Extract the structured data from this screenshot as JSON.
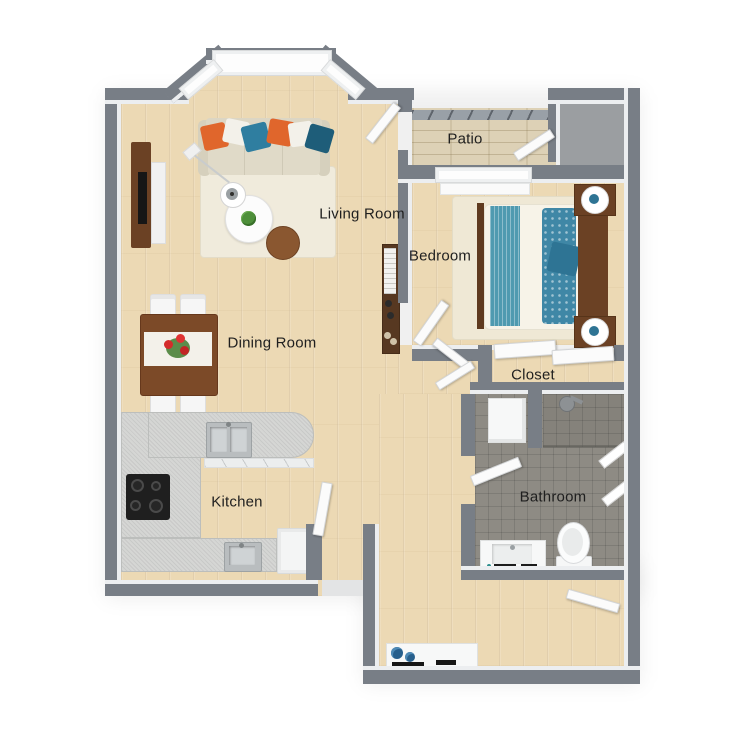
{
  "title": "One-bedroom apartment 3D floor plan",
  "rooms": {
    "patio": {
      "label": "Patio"
    },
    "living_room": {
      "label": "Living Room"
    },
    "bedroom": {
      "label": "Bedroom"
    },
    "dining_room": {
      "label": "Dining Room"
    },
    "closet": {
      "label": "Closet"
    },
    "kitchen": {
      "label": "Kitchen"
    },
    "bathroom": {
      "label": "Bathroom"
    }
  },
  "furniture": {
    "living_room": [
      "sofa",
      "throw-pillows",
      "coffee-table",
      "side-table",
      "floor-lamp",
      "tv-console",
      "area-rug",
      "potted-plant"
    ],
    "dining_room": [
      "dining-table",
      "four-chairs",
      "table-runner",
      "flower-centerpiece"
    ],
    "kitchen": [
      "peninsula-counter",
      "double-sink",
      "single-sink",
      "cooktop",
      "refrigerator"
    ],
    "bedroom": [
      "double-bed",
      "headboard",
      "two-nightstands",
      "two-table-lamps",
      "bookshelf",
      "area-rug"
    ],
    "bathroom": [
      "shower",
      "shower-head",
      "glass-panels",
      "toilet",
      "vanity-sink",
      "storage-stall"
    ],
    "patio": [
      "wood-deck",
      "railing",
      "storage-closet"
    ],
    "entry": [
      "console-table",
      "decor-bowls"
    ]
  },
  "palette": {
    "wall": "#787e86",
    "wall_face": "#eceef0",
    "wood": "#ecd9b4",
    "patio_wood": "#ddd1b6",
    "tile": "#8e8b84",
    "counter": "#d5d6d4",
    "accent_orange": "#e0662c",
    "accent_teal": "#2f7ea0",
    "accent_dark_teal": "#1e5d79",
    "bed_teal": "#4f9ab0",
    "furniture_wood": "#7c4a28",
    "label_color": "#1f1f1f"
  }
}
